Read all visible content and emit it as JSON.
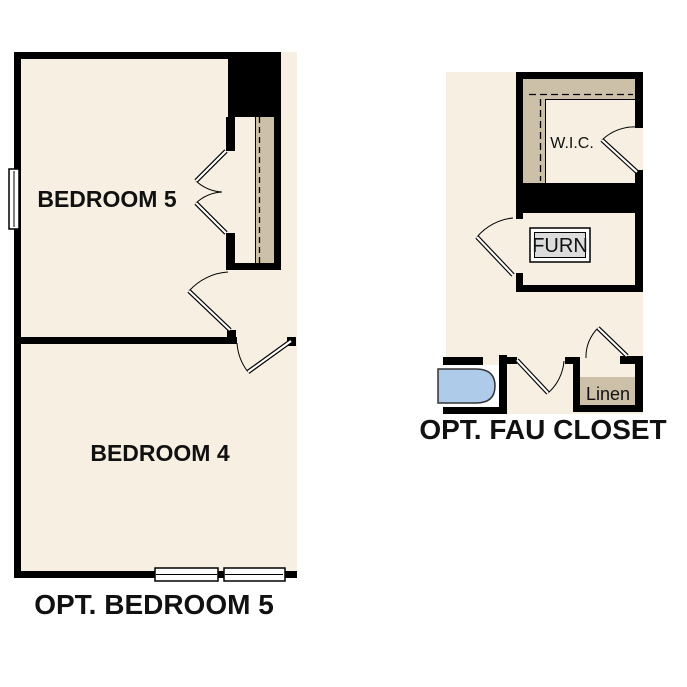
{
  "page": {
    "background": "#FFFFFF"
  },
  "colors": {
    "floor": "#F6EFE2",
    "wall": "#000000",
    "shelf": "#CDC0A8",
    "tub": "#AECBE9",
    "furnace_fill": "#DCDCDC",
    "label_text": "#111111"
  },
  "plans": {
    "opt_bedroom5": {
      "caption": "OPT. BEDROOM 5",
      "rooms": {
        "bedroom5": "BEDROOM 5",
        "bedroom4": "BEDROOM 4"
      }
    },
    "opt_fau_closet": {
      "caption": "OPT. FAU CLOSET",
      "rooms": {
        "wic": "W.I.C.",
        "furnace": "FURN",
        "linen": "Linen"
      }
    }
  }
}
